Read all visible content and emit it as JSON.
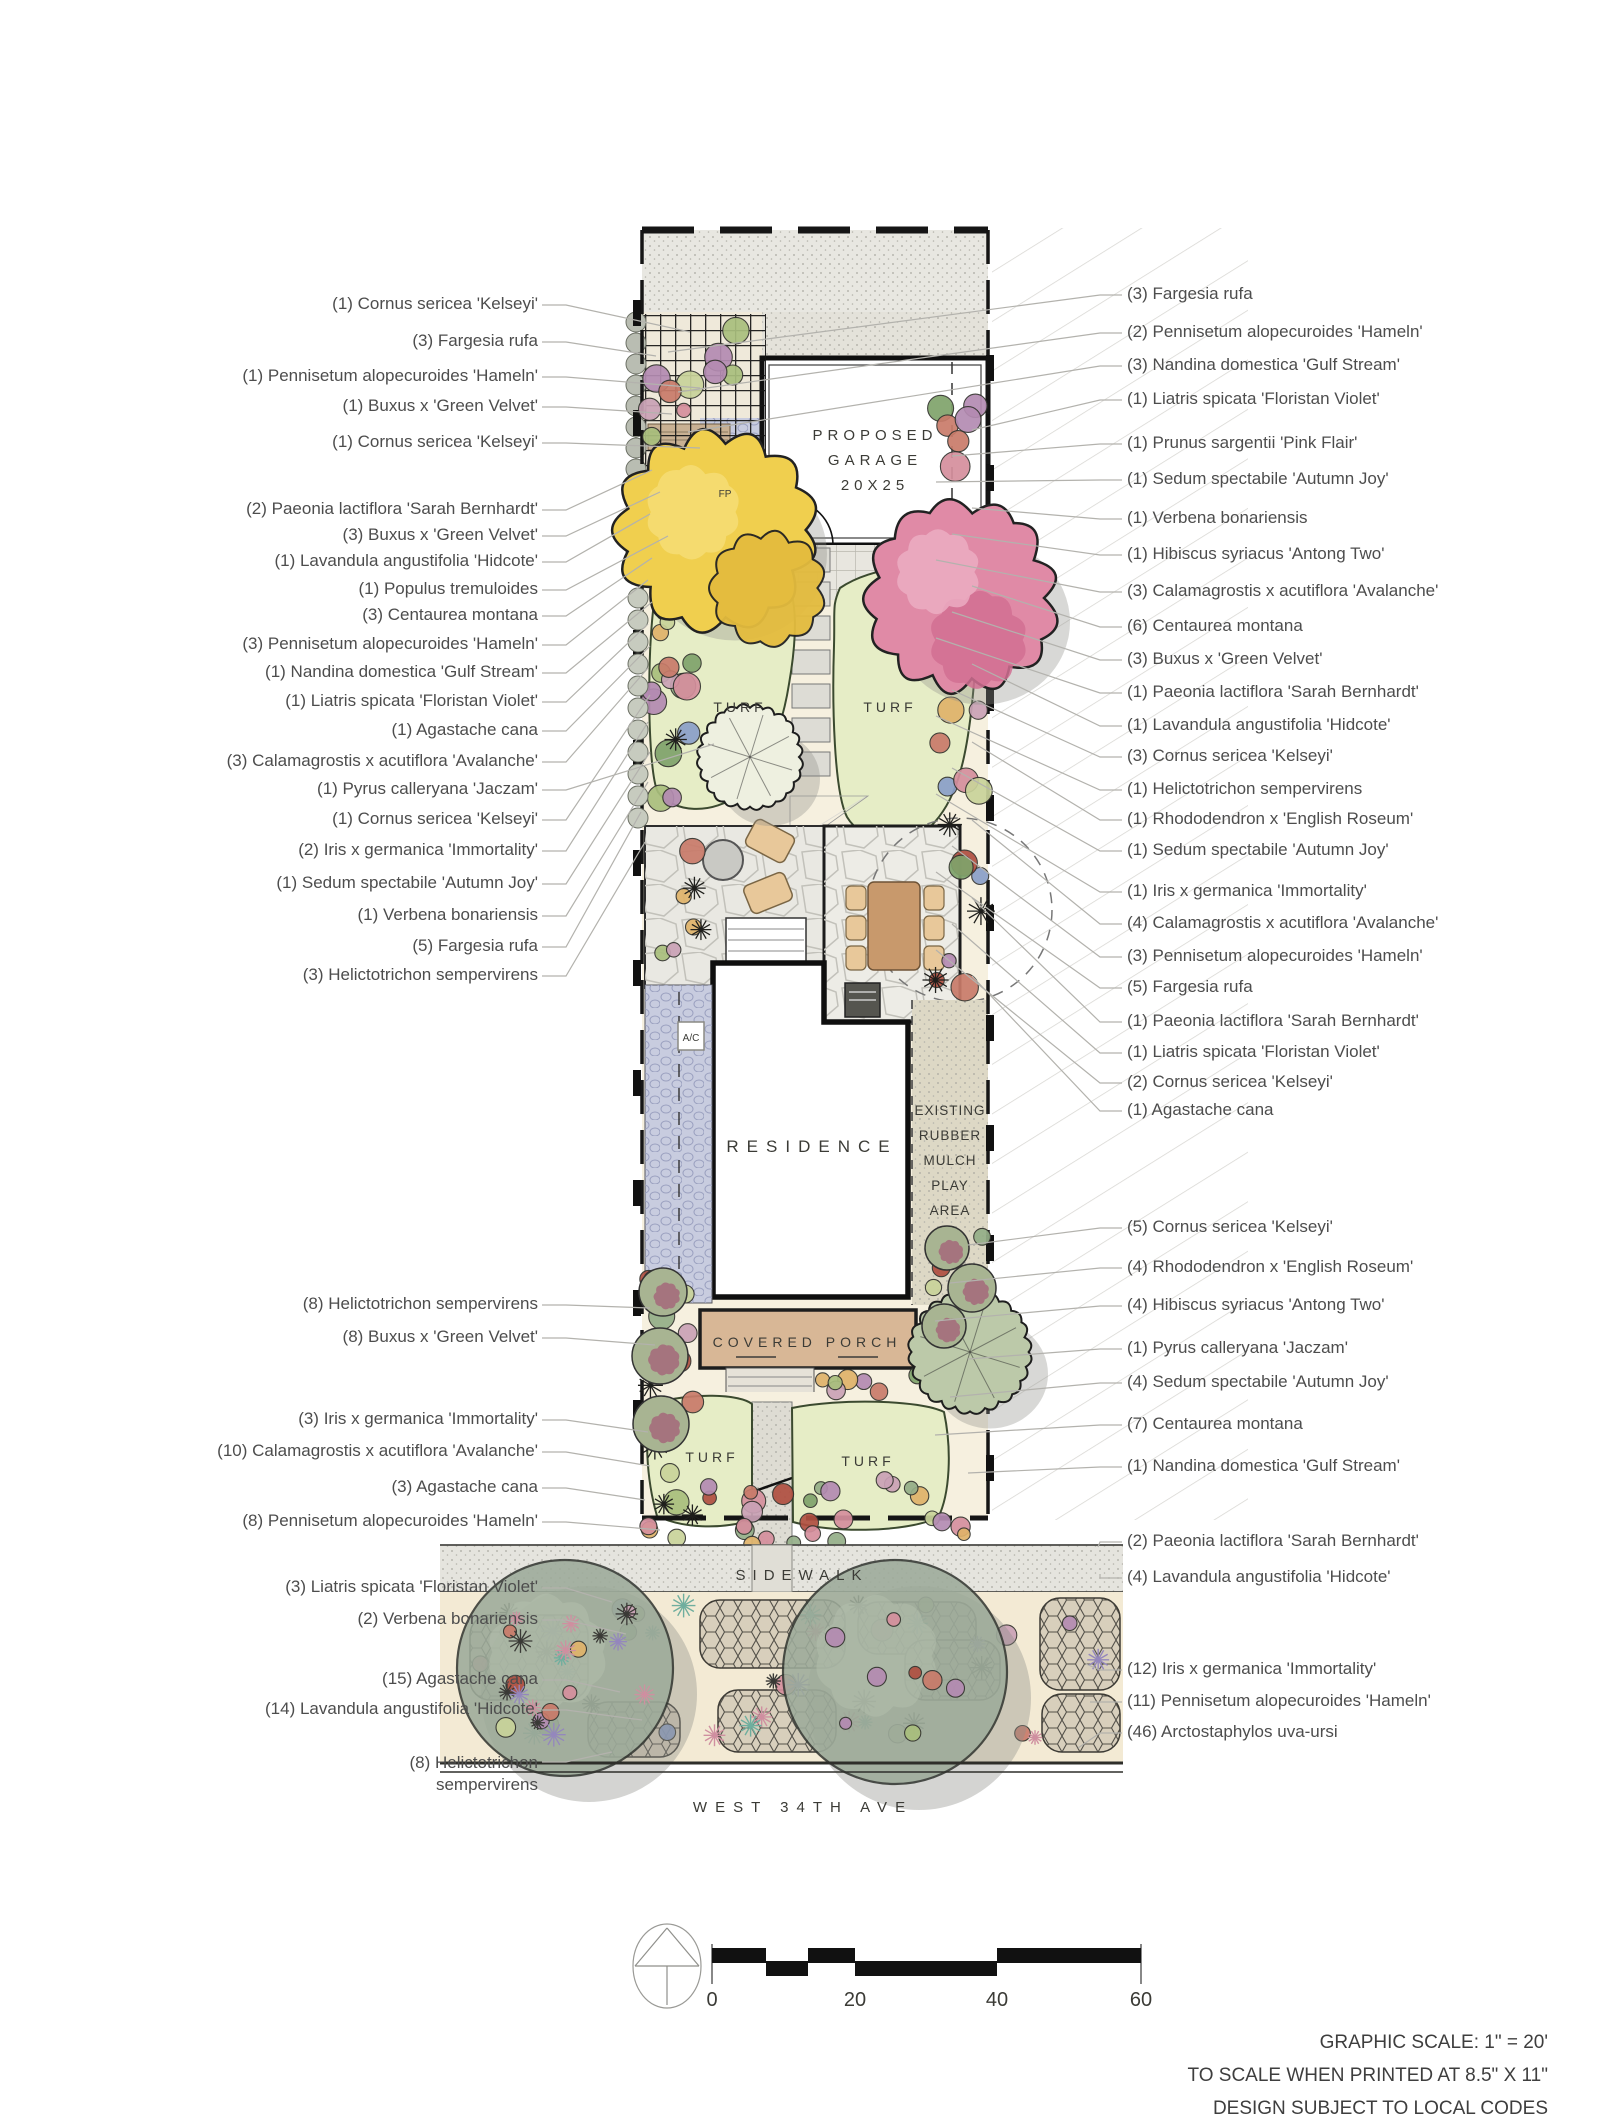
{
  "plan": {
    "garage_label_lines": [
      "PROPOSED",
      "GARAGE",
      "20X25"
    ],
    "residence_label": "RESIDENCE",
    "covered_porch_label": "COVERED PORCH",
    "play_area_label_lines": [
      "EXISTING",
      "RUBBER",
      "MULCH",
      "PLAY",
      "AREA"
    ],
    "turf_label": "TURF",
    "sidewalk_label": "SIDEWALK",
    "street_label": "WEST 34TH AVE",
    "fire_pit_label": "FP",
    "ac_label": "A/C"
  },
  "left_labels": [
    "(1) Cornus sericea 'Kelseyi'",
    "(3) Fargesia rufa",
    "(1) Pennisetum alopecuroides 'Hameln'",
    "(1) Buxus x 'Green Velvet'",
    "(1) Cornus sericea 'Kelseyi'",
    "(2) Paeonia lactiflora 'Sarah Bernhardt'",
    "(3) Buxus x 'Green Velvet'",
    "(1) Lavandula angustifolia 'Hidcote'",
    "(1) Populus tremuloides",
    "(3) Centaurea montana",
    "(3) Pennisetum alopecuroides 'Hameln'",
    "(1) Nandina domestica 'Gulf Stream'",
    "(1) Liatris spicata 'Floristan Violet'",
    "(1) Agastache cana",
    "(3) Calamagrostis x acutiflora 'Avalanche'",
    "(1) Pyrus calleryana 'Jaczam'",
    "(1) Cornus sericea 'Kelseyi'",
    "(2) Iris x germanica 'Immortality'",
    "(1) Sedum spectabile 'Autumn Joy'",
    "(1) Verbena bonariensis",
    "(5) Fargesia rufa",
    "(3) Helictotrichon sempervirens",
    "(8) Helictotrichon sempervirens",
    "(8) Buxus x 'Green Velvet'",
    "(3) Iris x germanica 'Immortality'",
    "(10) Calamagrostis x acutiflora 'Avalanche'",
    "(3) Agastache cana",
    "(8) Pennisetum alopecuroides 'Hameln'",
    "(3) Liatris spicata 'Floristan Violet'",
    "(2) Verbena bonariensis",
    "(15) Agastache cana",
    "(14) Lavandula angustifolia 'Hidcote'",
    "(8) Helictotrichon sempervirens"
  ],
  "right_labels": [
    "(3) Fargesia rufa",
    "(2) Pennisetum alopecuroides 'Hameln'",
    "(3) Nandina domestica 'Gulf Stream'",
    "(1) Liatris spicata 'Floristan Violet'",
    "(1) Prunus sargentii 'Pink Flair'",
    "(1) Sedum spectabile 'Autumn Joy'",
    "(1) Verbena bonariensis",
    "(1) Hibiscus syriacus 'Antong Two'",
    "(3) Calamagrostis x acutiflora 'Avalanche'",
    "(6) Centaurea montana",
    "(3) Buxus x 'Green Velvet'",
    "(1) Paeonia lactiflora 'Sarah Bernhardt'",
    "(1) Lavandula angustifolia 'Hidcote'",
    "(3) Cornus sericea 'Kelseyi'",
    "(1) Helictotrichon sempervirens",
    "(1) Rhododendron x 'English Roseum'",
    "(1) Sedum spectabile 'Autumn Joy'",
    "(1) Iris x germanica 'Immortality'",
    "(4) Calamagrostis x acutiflora 'Avalanche'",
    "(3) Pennisetum alopecuroides 'Hameln'",
    "(5) Fargesia rufa",
    "(1) Paeonia lactiflora 'Sarah Bernhardt'",
    "(1) Liatris spicata 'Floristan Violet'",
    "(2) Cornus sericea 'Kelseyi'",
    "(1) Agastache cana",
    "(5) Cornus sericea 'Kelseyi'",
    "(4) Rhododendron x 'English Roseum'",
    "(4) Hibiscus syriacus 'Antong Two'",
    "(1) Pyrus calleryana 'Jaczam'",
    "(4) Sedum spectabile 'Autumn Joy'",
    "(7) Centaurea montana",
    "(1) Nandina domestica 'Gulf Stream'",
    "(2) Paeonia lactiflora 'Sarah Bernhardt'",
    "(4) Lavandula angustifolia 'Hidcote'",
    "(12) Iris x germanica 'Immortality'",
    "(11) Pennisetum alopecuroides 'Hameln'",
    "(46) Arctostaphylos uva-ursi"
  ],
  "scale_bar": {
    "ticks": [
      "0",
      "20",
      "40",
      "60"
    ]
  },
  "notes": [
    "GRAPHIC SCALE: 1\" = 20'",
    "TO SCALE WHEN PRINTED AT 8.5\" X 11\"",
    "DESIGN SUBJECT TO LOCAL CODES"
  ],
  "colors": {
    "turf": "#e6edc6",
    "turf_edge": "#3b4a2f",
    "canopy_yellow": "#f0cf4e",
    "canopy_pink": "#e08aa6",
    "porch_tan": "#d8b796",
    "driveway_paver": "#c8ccdf",
    "street_tree": "#9dab9a",
    "bed_cream": "#f6f0df",
    "label_text": "#4d4d4d"
  }
}
